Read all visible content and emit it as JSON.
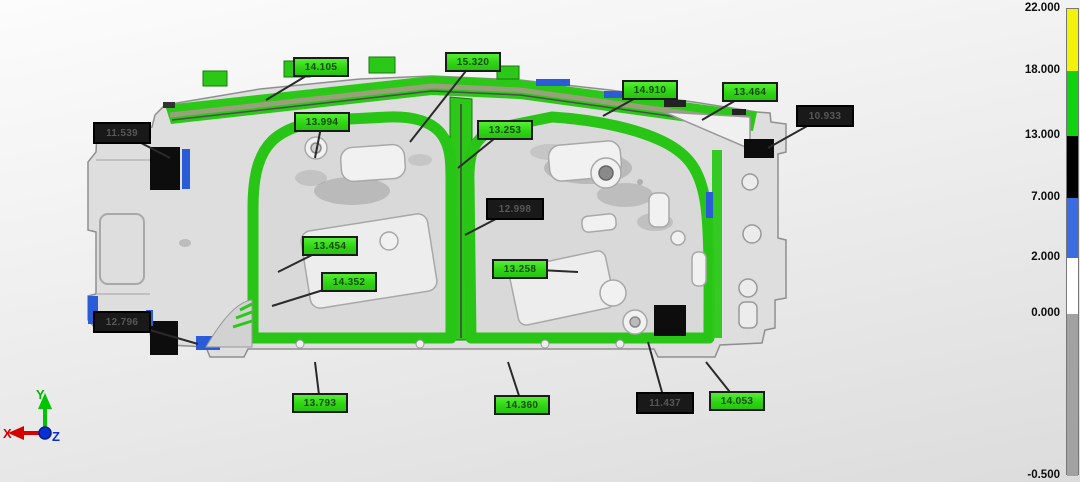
{
  "viewport": {
    "name": "deviation-inspection-view"
  },
  "annotations": [
    {
      "label": "14.105",
      "type": "green",
      "x": 293,
      "y": 57,
      "tx": 266,
      "ty": 100
    },
    {
      "label": "15.320",
      "type": "green",
      "x": 445,
      "y": 52,
      "tx": 410,
      "ty": 142
    },
    {
      "label": "14.910",
      "type": "green",
      "x": 622,
      "y": 80,
      "tx": 603,
      "ty": 116
    },
    {
      "label": "13.464",
      "type": "green",
      "x": 722,
      "y": 82,
      "tx": 702,
      "ty": 120
    },
    {
      "label": "10.933",
      "type": "black",
      "x": 796,
      "y": 105,
      "tx": 768,
      "ty": 148
    },
    {
      "label": "11.539",
      "type": "black",
      "x": 93,
      "y": 122,
      "tx": 170,
      "ty": 158
    },
    {
      "label": "13.994",
      "type": "green",
      "x": 294,
      "y": 112,
      "tx": 315,
      "ty": 158
    },
    {
      "label": "13.253",
      "type": "green",
      "x": 477,
      "y": 120,
      "tx": 458,
      "ty": 168
    },
    {
      "label": "12.998",
      "type": "black",
      "x": 486,
      "y": 198,
      "tx": 465,
      "ty": 235
    },
    {
      "label": "13.454",
      "type": "green",
      "x": 302,
      "y": 236,
      "tx": 278,
      "ty": 272
    },
    {
      "label": "14.352",
      "type": "green",
      "x": 321,
      "y": 272,
      "tx": 272,
      "ty": 306
    },
    {
      "label": "13.258",
      "type": "green",
      "x": 492,
      "y": 259,
      "tx": 578,
      "ty": 272
    },
    {
      "label": "12.796",
      "type": "black",
      "x": 93,
      "y": 311,
      "tx": 198,
      "ty": 344
    },
    {
      "label": "13.793",
      "type": "green",
      "x": 292,
      "y": 393,
      "tx": 315,
      "ty": 362
    },
    {
      "label": "14.360",
      "type": "green",
      "x": 494,
      "y": 395,
      "tx": 508,
      "ty": 362
    },
    {
      "label": "11.437",
      "type": "black",
      "x": 636,
      "y": 392,
      "tx": 648,
      "ty": 342
    },
    {
      "label": "14.053",
      "type": "green",
      "x": 709,
      "y": 391,
      "tx": 706,
      "ty": 362
    }
  ],
  "colorbar": {
    "ticks": [
      {
        "value": "22.000",
        "y": 8
      },
      {
        "value": "18.000",
        "y": 70
      },
      {
        "value": "13.000",
        "y": 135
      },
      {
        "value": "7.000",
        "y": 197
      },
      {
        "value": "2.000",
        "y": 257
      },
      {
        "value": "0.000",
        "y": 313
      },
      {
        "value": "-0.500",
        "y": 475
      }
    ],
    "segments": [
      {
        "color": "#f2f20a",
        "from": "22.000",
        "to": "18.000"
      },
      {
        "color": "#0ed30e",
        "from": "18.000",
        "to": "13.000"
      },
      {
        "color": "#000000",
        "from": "13.000",
        "to": "7.000"
      },
      {
        "color": "#3a6ce2",
        "from": "7.000",
        "to": "2.000"
      },
      {
        "color": "#ffffff",
        "from": "2.000",
        "to": "0.000"
      },
      {
        "color": "#a2a2a2",
        "from": "0.000",
        "to": "-0.500"
      }
    ]
  },
  "axis_triad": {
    "x_label": "X",
    "y_label": "Y",
    "z_label": "Z",
    "x_color": "#d40000",
    "y_color": "#00c400",
    "z_color": "#0a2fd0"
  },
  "part_colors": {
    "green": "#2bc818",
    "body_gray": "#dedede",
    "blue": "#2a5cd8",
    "black": "#0d0d0d"
  }
}
